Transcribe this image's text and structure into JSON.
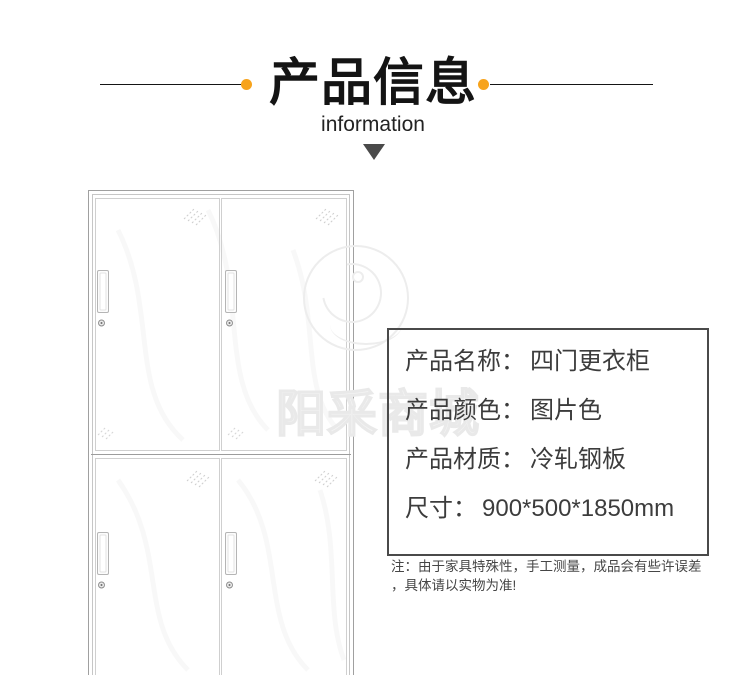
{
  "header": {
    "title": "产品信息",
    "subtitle": "information",
    "accent_dot_color": "#F7A31C",
    "line_color": "#151515",
    "arrow_color": "#4A4A4A"
  },
  "watermark": {
    "text": "阳采商城"
  },
  "product_drawing": {
    "alt": "四门更衣柜线稿图",
    "doors": 4,
    "line_color": "#c6c6c6"
  },
  "info_box": {
    "border_color": "#4A4A4A",
    "text_color": "#3C3C3C",
    "rows": [
      {
        "label": "产品名称：",
        "value": "四门更衣柜"
      },
      {
        "label": "产品颜色：",
        "value": "图片色"
      },
      {
        "label": "产品材质：",
        "value": "冷轧钢板"
      },
      {
        "label": "尺寸：",
        "value": "900*500*1850mm"
      }
    ],
    "note": {
      "line1": "注：由于家具特殊性，手工测量，成品会有些许误差",
      "line2": "，具体请以实物为准!"
    }
  }
}
